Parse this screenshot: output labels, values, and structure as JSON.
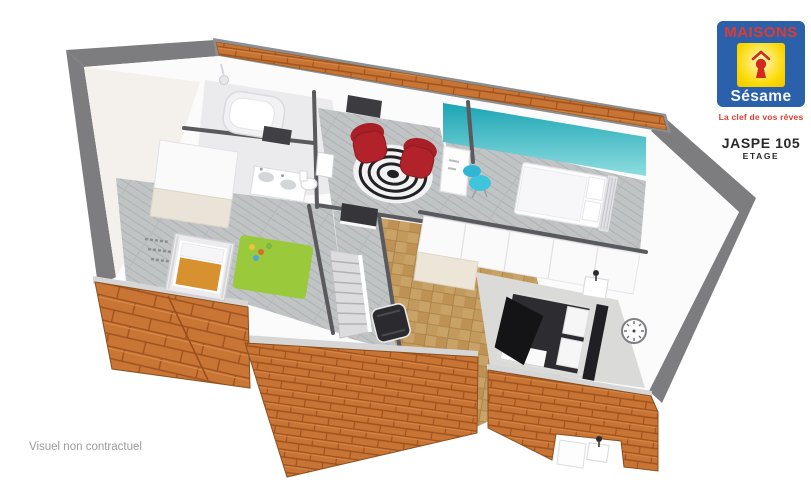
{
  "brand": {
    "name": "MAISONS",
    "sub_name": "Sésame",
    "tagline": "La clef de vos rêves",
    "logo_icon": "keyhole-under-roof-icon"
  },
  "plan": {
    "title": "JASPE 105",
    "subtitle": "ETAGE"
  },
  "caption": "Visuel non contractuel",
  "colors": {
    "logo_blue": "#2a61aa",
    "logo_yellow": "#fbd800",
    "logo_red": "#e23b2e",
    "logo_sub_white": "#f5f7fa",
    "roof_tile_orange": "#c87434",
    "roof_tile_line": "#a0521e",
    "band_gray": "#7d7d80",
    "teal_wall": "#1ba4b3",
    "rug_green": "#9aca3c",
    "armchair_red": "#b2222a",
    "chair_cyan": "#3fc4de",
    "wood_floor_gray": "#c1c4c5",
    "parquet_tan": "#c9a268",
    "title_text": "#29292b",
    "caption_gray": "#9b9b9b"
  },
  "floorplan": {
    "label": "3D isometric view of the upper floor",
    "rooms": [
      {
        "name": "salle-de-bains",
        "items": [
          "bathtub",
          "shower-head",
          "bath-mat",
          "double-sink-vanity",
          "toilet"
        ]
      },
      {
        "name": "chambre-enfant",
        "items": [
          "crib",
          "green-rug",
          "toys",
          "wardrobe",
          "wall-letters-decor"
        ]
      },
      {
        "name": "mezzanine",
        "items": [
          "red-armchair",
          "red-armchair",
          "striped-round-rug"
        ]
      },
      {
        "name": "chambre-1",
        "items": [
          "single-bed",
          "desk",
          "cyan-desk-chair",
          "teal-accent-wall"
        ]
      },
      {
        "name": "palier",
        "items": [
          "staircase",
          "stairwell"
        ]
      },
      {
        "name": "chambre-parentale",
        "items": [
          "double-bed-dark",
          "wardrobe-row",
          "nightstand",
          "table-lamp",
          "black-armchair",
          "wall-clock",
          "carpet"
        ]
      }
    ]
  }
}
